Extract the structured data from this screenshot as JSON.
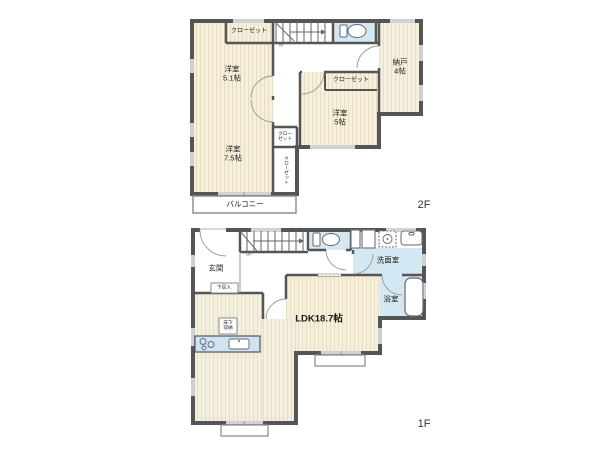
{
  "colors": {
    "wall": "#555555",
    "floor_beige": "#f5efde",
    "floor_stripe": "#e7ddc3",
    "wet_blue": "#d3e8f3",
    "text": "#1a1a1a"
  },
  "floor2": {
    "label": "2F",
    "closet_top": "クローゼット",
    "room_51_name": "洋室",
    "room_51_size": "5.1帖",
    "nando_name": "納戸",
    "nando_size": "4帖",
    "closet_mid": "クローゼット",
    "room_5_name": "洋室",
    "room_5_size": "5帖",
    "room_75_name": "洋室",
    "room_75_size": "7.5帖",
    "closet_small_1": "クロー",
    "closet_small_2": "ゼット",
    "closet_vert": "クローゼット",
    "balcony": "バルコニー",
    "stair_mark": "M"
  },
  "floor1": {
    "label": "1F",
    "genkan": "玄関",
    "shoe_box": "下足入",
    "washroom": "洗面室",
    "bathroom": "浴室",
    "ldk": "LDK18.7帖",
    "underfloor_1": "床下",
    "underfloor_2": "収納",
    "stair_mark": "UP"
  }
}
